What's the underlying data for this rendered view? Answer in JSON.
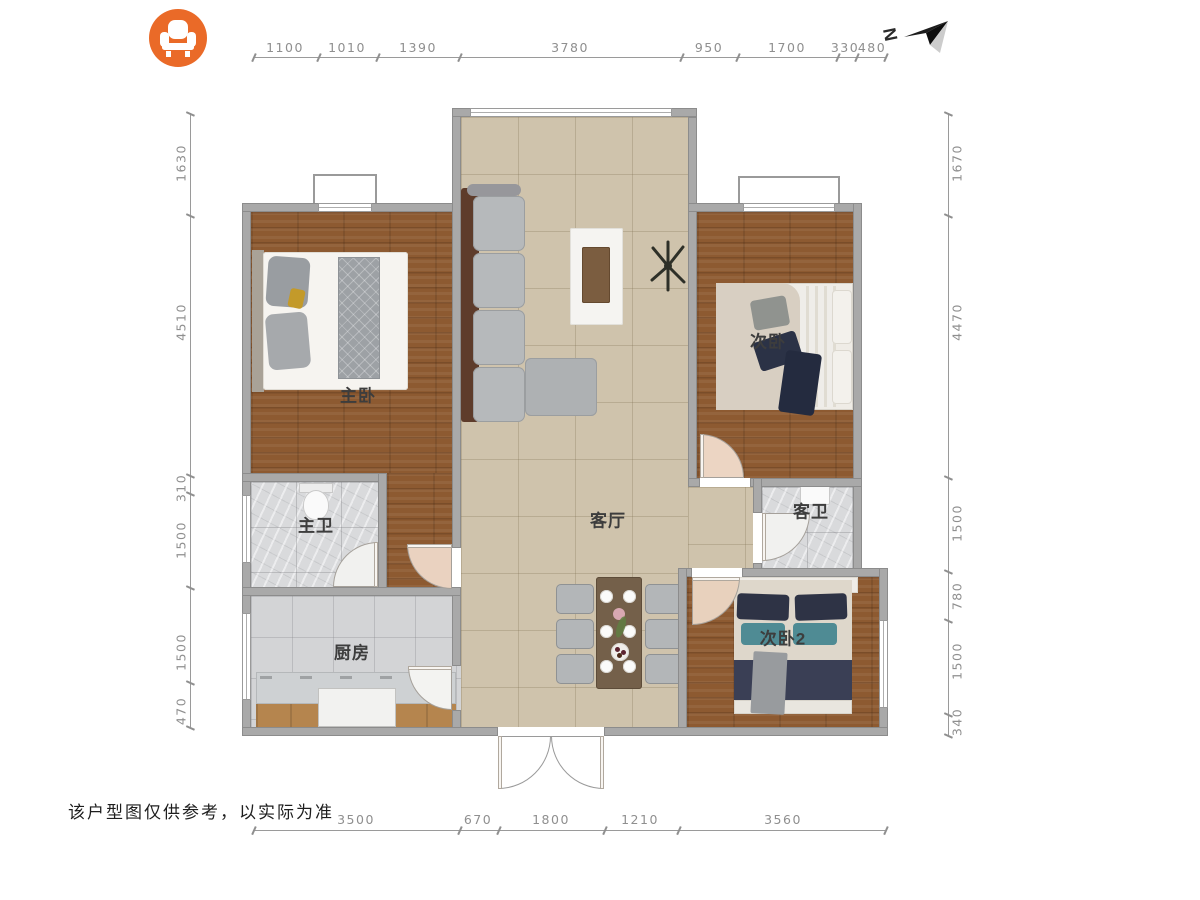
{
  "header": {
    "brand_icon": "sofa-icon",
    "brand_color": "#ea6a28",
    "compass_label": "N"
  },
  "rooms": {
    "master_bedroom": "主卧",
    "bedroom2": "次卧",
    "bedroom3": "次卧2",
    "living": "客厅",
    "master_bath": "主卫",
    "guest_bath": "客卫",
    "kitchen": "厨房"
  },
  "dimensions": {
    "top": [
      "1100",
      "1010",
      "1390",
      "3780",
      "950",
      "1700",
      "330",
      "480"
    ],
    "bottom": [
      "3500",
      "670",
      "1800",
      "1210",
      "3560"
    ],
    "left": [
      "1630",
      "4510",
      "310",
      "1500",
      "1500",
      "470"
    ],
    "right": [
      "1670",
      "4470",
      "1500",
      "780",
      "1500",
      "340"
    ]
  },
  "footer": {
    "disclaimer": "该户型图仅供参考，以实际为准"
  }
}
